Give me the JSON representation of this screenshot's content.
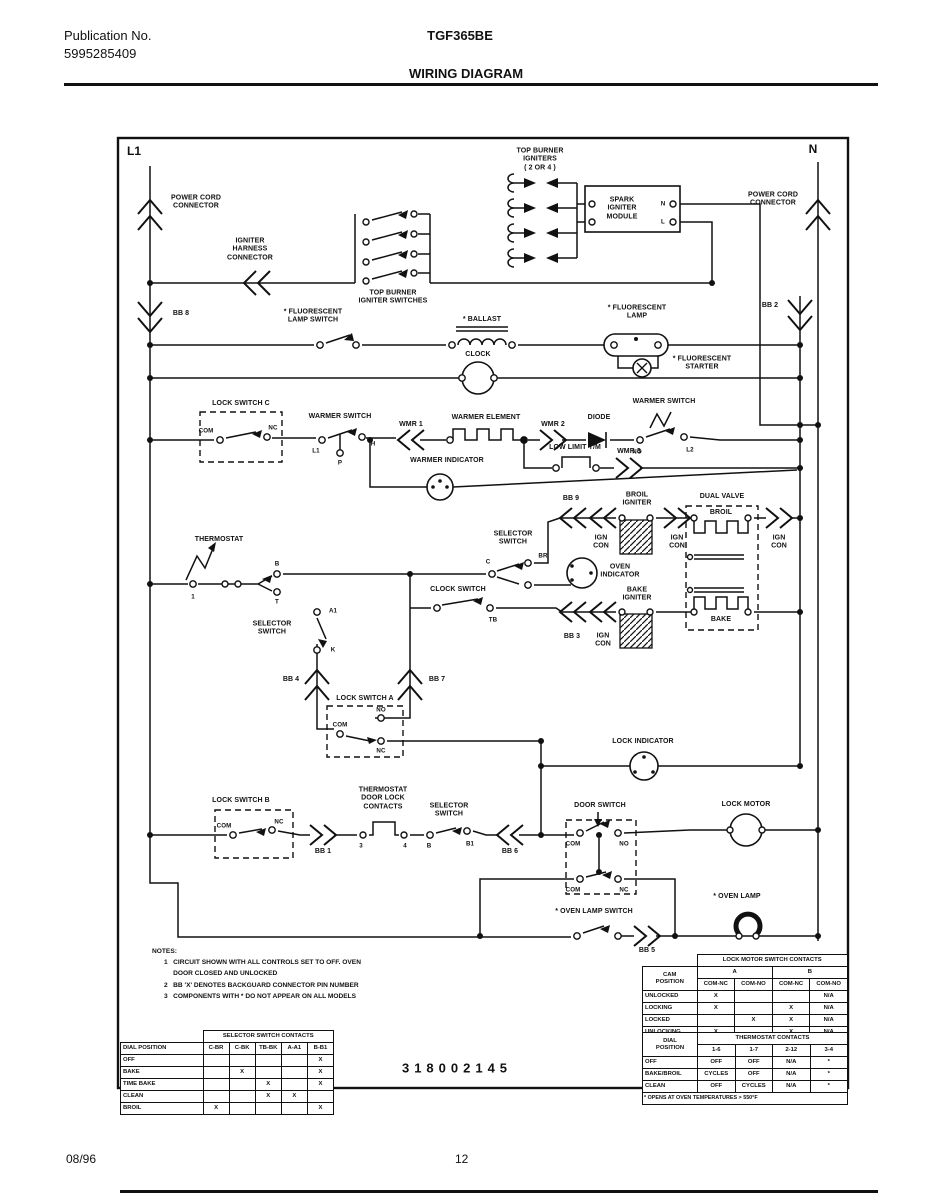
{
  "header": {
    "publication_label": "Publication No.",
    "publication_number": "5995285409",
    "model": "TGF365BE",
    "title": "WIRING DIAGRAM"
  },
  "footer": {
    "date": "08/96",
    "page": "12"
  },
  "diagram": {
    "part_number": "318002145",
    "bus": {
      "l1": "L1",
      "n": "N"
    },
    "labels": {
      "power_cord_left": "POWER CORD\nCONNECTOR",
      "igniter_harness": "IGNITER\nHARNESS\nCONNECTOR",
      "top_burner_switches": "TOP BURNER\nIGNITER SWITCHES",
      "top_burner_igniters": "TOP BURNER\nIGNITERS\n( 2 OR 4 )",
      "spark_module": "SPARK\nIGNITER\nMODULE",
      "power_cord_right": "POWER CORD\nCONNECTOR",
      "fluorescent_lamp_switch": "* FLUORESCENT\nLAMP SWITCH",
      "ballast": "* BALLAST",
      "clock": "CLOCK",
      "fluorescent_lamp": "* FLUORESCENT\nLAMP",
      "fluorescent_starter": "* FLUORESCENT\nSTARTER",
      "lock_switch_c": "LOCK SWITCH C",
      "warmer_switch_left": "WARMER SWITCH",
      "wmr1": "WMR 1",
      "warmer_element": "WARMER ELEMENT",
      "wmr2": "WMR 2",
      "diode": "DIODE",
      "warmer_switch_right": "WARMER SWITCH",
      "low_limit": "LOW LIMIT T/M",
      "wmr3": "WMR 3",
      "warmer_indicator": "WARMER INDICATOR",
      "thermostat": "THERMOSTAT",
      "selector_switch_left": "SELECTOR\nSWITCH",
      "clock_switch": "CLOCK SWITCH",
      "selector_switch_right": "SELECTOR\nSWITCH",
      "oven_indicator": "OVEN\nINDICATOR",
      "broil_igniter": "BROIL\nIGNITER",
      "bake_igniter": "BAKE\nIGNITER",
      "dual_valve": "DUAL VALVE",
      "broil": "BROIL",
      "bake": "BAKE",
      "ign_con": "IGN\nCON",
      "lock_switch_a": "LOCK SWITCH A",
      "lock_indicator": "LOCK INDICATOR",
      "lock_switch_b": "LOCK SWITCH B",
      "thermostat_door_lock": "THERMOSTAT\nDOOR LOCK\nCONTACTS",
      "selector_switch_bottom": "SELECTOR\nSWITCH",
      "door_switch": "DOOR SWITCH",
      "lock_motor": "LOCK MOTOR",
      "oven_lamp_switch": "* OVEN LAMP SWITCH",
      "oven_lamp": "* OVEN LAMP",
      "bb8": "BB 8",
      "bb2": "BB 2",
      "bb9": "BB 9",
      "bb3": "BB 3",
      "bb4": "BB 4",
      "bb7": "BB 7",
      "bb1": "BB 1",
      "bb6": "BB 6",
      "bb5": "BB 5"
    },
    "terminals": {
      "com": "COM",
      "nc": "NC",
      "no": "NO",
      "l1": "L1",
      "p": "P",
      "h": "H",
      "l2": "L2",
      "n": "N",
      "l": "L",
      "one": "1",
      "b": "B",
      "t": "T",
      "a1": "A1",
      "k": "K",
      "c": "C",
      "tb": "TB",
      "br": "BR",
      "three": "3",
      "four": "4",
      "b1": "B1"
    },
    "notes": {
      "title": "NOTES:",
      "items": [
        "1   CIRCUIT SHOWN WITH ALL CONTROLS SET TO OFF. OVEN\n     DOOR CLOSED AND UNLOCKED",
        "2   BB 'X' DENOTES BACKGUARD CONNECTOR PIN NUMBER",
        "3   COMPONENTS WITH * DO NOT APPEAR ON ALL MODELS"
      ]
    }
  },
  "tables": {
    "selector": {
      "title": "SELECTOR SWITCH CONTACTS",
      "row_header": "DIAL POSITION",
      "columns": [
        "C-BR",
        "C-BK",
        "TB-BK",
        "A-A1",
        "B-B1"
      ],
      "rows": [
        {
          "name": "OFF",
          "cells": [
            "",
            "",
            "",
            "",
            "X"
          ]
        },
        {
          "name": "BAKE",
          "cells": [
            "",
            "X",
            "",
            "",
            "X"
          ]
        },
        {
          "name": "TIME BAKE",
          "cells": [
            "",
            "",
            "X",
            "",
            "X"
          ]
        },
        {
          "name": "CLEAN",
          "cells": [
            "",
            "",
            "X",
            "X",
            ""
          ]
        },
        {
          "name": "BROIL",
          "cells": [
            "X",
            "",
            "",
            "",
            "X"
          ]
        }
      ]
    },
    "lock_motor": {
      "title": "LOCK MOTOR SWITCH CONTACTS",
      "row_header": "CAM\nPOSITION",
      "groups": [
        "A",
        "B"
      ],
      "columns": [
        "COM-NC",
        "COM-NO",
        "COM-NC",
        "COM-NO"
      ],
      "rows": [
        {
          "name": "UNLOCKED",
          "cells": [
            "X",
            "",
            "",
            "N/A"
          ]
        },
        {
          "name": "LOCKING",
          "cells": [
            "X",
            "",
            "X",
            "N/A"
          ]
        },
        {
          "name": "LOCKED",
          "cells": [
            "",
            "X",
            "X",
            "N/A"
          ]
        },
        {
          "name": "UNLOCKING",
          "cells": [
            "X",
            "",
            "X",
            "N/A"
          ]
        }
      ]
    },
    "thermostat": {
      "title": "THERMOSTAT CONTACTS",
      "row_header": "DIAL\nPOSITION",
      "columns": [
        "1-6",
        "1-7",
        "2-12",
        "3-4"
      ],
      "rows": [
        {
          "name": "OFF",
          "cells": [
            "OFF",
            "OFF",
            "N/A",
            "*"
          ]
        },
        {
          "name": "BAKE/BROIL",
          "cells": [
            "CYCLES",
            "OFF",
            "N/A",
            "*"
          ]
        },
        {
          "name": "CLEAN",
          "cells": [
            "OFF",
            "CYCLES",
            "N/A",
            "*"
          ]
        }
      ],
      "footnote": "* OPENS AT OVEN TEMPERATURES > 550°F"
    }
  }
}
